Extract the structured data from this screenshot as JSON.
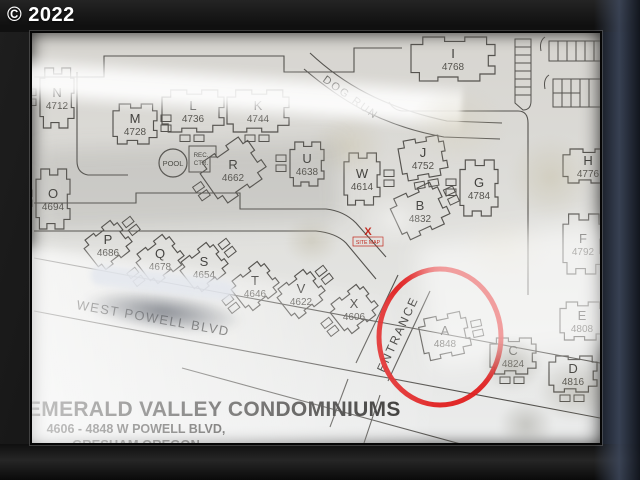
{
  "watermark": "© 2022",
  "sign": {
    "title": "EMERALD VALLEY CONDOMINIUMS",
    "address_line": "4606 - 4848  W POWELL BLVD,",
    "city_line": "GRESHAM OREGON"
  },
  "map": {
    "street_label": "WEST POWELL  BLVD",
    "entrance_label": "ENTRANCE",
    "dog_run_label": "DOG RUN",
    "pool_label": "POOL",
    "rec_center": {
      "line1": "REC.",
      "line2": "CTR."
    },
    "site_marker": {
      "symbol": "X",
      "label": "SITE MAP"
    },
    "colors": {
      "highlight_red": "#e01f1f",
      "marker_red": "#bf2318",
      "line": "#54524e",
      "label": "#403f3c"
    },
    "buildings": [
      {
        "letter": "A",
        "number": "4848",
        "x": 413,
        "y": 297,
        "rot": -12,
        "w": 48,
        "h": 42,
        "g": "right"
      },
      {
        "letter": "B",
        "number": "4832",
        "x": 388,
        "y": 172,
        "rot": -25,
        "w": 52,
        "h": 44,
        "g": "right"
      },
      {
        "letter": "C",
        "number": "4824",
        "x": 481,
        "y": 317,
        "rot": 0,
        "w": 46,
        "h": 36,
        "g": "below"
      },
      {
        "letter": "D",
        "number": "4816",
        "x": 541,
        "y": 335,
        "rot": 0,
        "w": 48,
        "h": 36,
        "g": "below"
      },
      {
        "letter": "E",
        "number": "4808",
        "x": 550,
        "y": 282,
        "rot": 0,
        "w": 44,
        "h": 38,
        "g": "right"
      },
      {
        "letter": "F",
        "number": "4792",
        "x": 551,
        "y": 205,
        "rot": 0,
        "w": 40,
        "h": 60,
        "g": "right"
      },
      {
        "letter": "G",
        "number": "4784",
        "x": 447,
        "y": 149,
        "rot": 0,
        "w": 38,
        "h": 56,
        "g": "left"
      },
      {
        "letter": "H",
        "number": "4776",
        "x": 556,
        "y": 127,
        "rot": 0,
        "w": 50,
        "h": 34,
        "g": "right"
      },
      {
        "letter": "I",
        "number": "4768",
        "x": 421,
        "y": 20,
        "rot": 0,
        "w": 84,
        "h": 44,
        "g": "none"
      },
      {
        "letter": "J",
        "number": "4752",
        "x": 391,
        "y": 119,
        "rot": -10,
        "w": 46,
        "h": 40,
        "g": "below"
      },
      {
        "letter": "K",
        "number": "4744",
        "x": 226,
        "y": 72,
        "rot": 0,
        "w": 62,
        "h": 42,
        "g": "below"
      },
      {
        "letter": "L",
        "number": "4736",
        "x": 161,
        "y": 72,
        "rot": 0,
        "w": 62,
        "h": 42,
        "g": "below"
      },
      {
        "letter": "M",
        "number": "4728",
        "x": 103,
        "y": 85,
        "rot": 0,
        "w": 44,
        "h": 40,
        "g": "right"
      },
      {
        "letter": "N",
        "number": "4712",
        "x": 25,
        "y": 59,
        "rot": 0,
        "w": 34,
        "h": 60,
        "g": "left"
      },
      {
        "letter": "O",
        "number": "4694",
        "x": 21,
        "y": 160,
        "rot": 0,
        "w": 34,
        "h": 60,
        "g": "left"
      },
      {
        "letter": "P",
        "number": "4686",
        "x": 76,
        "y": 206,
        "rot": -38,
        "w": 42,
        "h": 36,
        "g": "right"
      },
      {
        "letter": "Q",
        "number": "4678",
        "x": 128,
        "y": 220,
        "rot": -38,
        "w": 42,
        "h": 36,
        "g": "left"
      },
      {
        "letter": "R",
        "number": "4662",
        "x": 201,
        "y": 131,
        "rot": -35,
        "w": 58,
        "h": 48,
        "g": "left"
      },
      {
        "letter": "S",
        "number": "4654",
        "x": 172,
        "y": 228,
        "rot": -38,
        "w": 42,
        "h": 36,
        "g": "right"
      },
      {
        "letter": "T",
        "number": "4646",
        "x": 223,
        "y": 247,
        "rot": -38,
        "w": 42,
        "h": 36,
        "g": "left"
      },
      {
        "letter": "U",
        "number": "4638",
        "x": 275,
        "y": 125,
        "rot": 0,
        "w": 34,
        "h": 44,
        "g": "left"
      },
      {
        "letter": "V",
        "number": "4622",
        "x": 269,
        "y": 255,
        "rot": -38,
        "w": 42,
        "h": 36,
        "g": "right"
      },
      {
        "letter": "W",
        "number": "4614",
        "x": 330,
        "y": 140,
        "rot": 0,
        "w": 36,
        "h": 52,
        "g": "right"
      },
      {
        "letter": "X",
        "number": "4606",
        "x": 322,
        "y": 270,
        "rot": -38,
        "w": 42,
        "h": 36,
        "g": "left"
      }
    ]
  }
}
